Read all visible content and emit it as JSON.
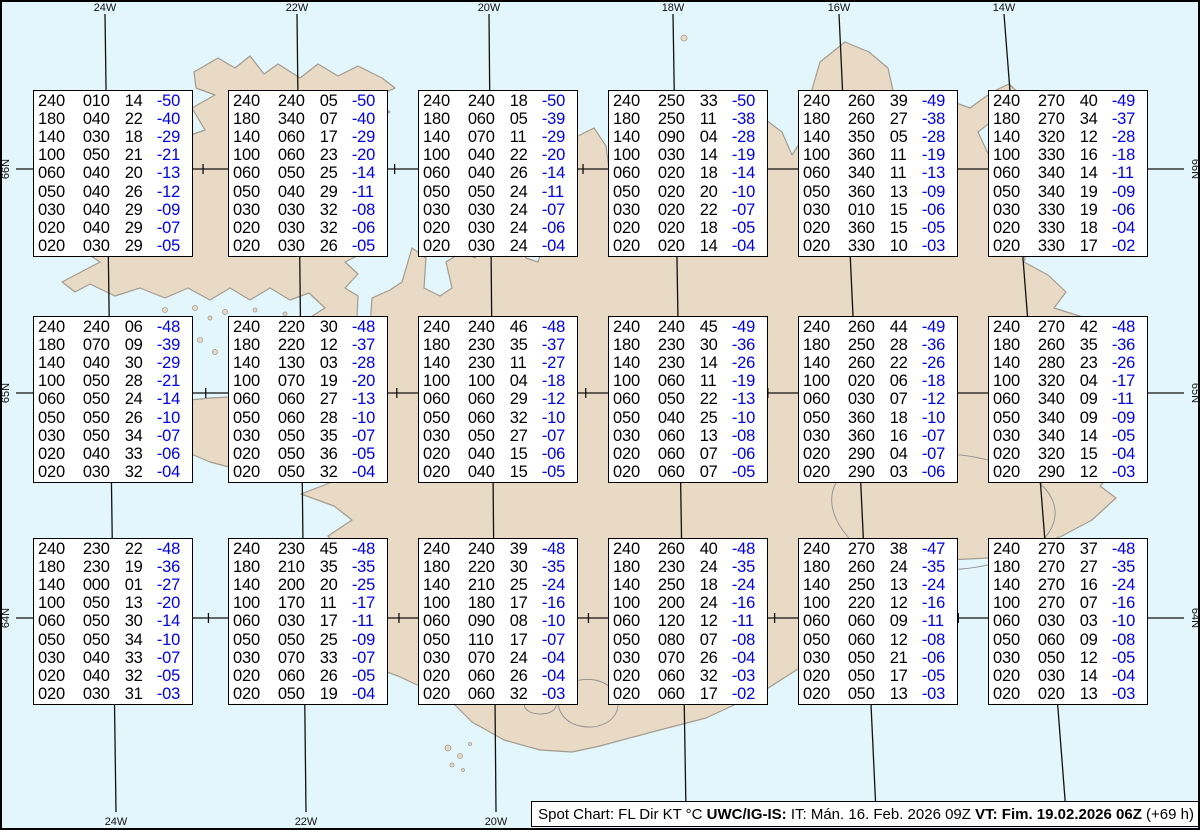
{
  "colors": {
    "ocean": "#e3f6fb",
    "land": "#e8dac5",
    "coastline": "#a39b90",
    "grid": "#111111",
    "temperature_blue": "#0000e0",
    "box_background": "#ffffff"
  },
  "graticule": {
    "meridians": [
      {
        "label": "24W",
        "x_top": 105,
        "x_bottom": 116
      },
      {
        "label": "22W",
        "x_top": 297,
        "x_bottom": 306
      },
      {
        "label": "20W",
        "x_top": 489,
        "x_bottom": 496
      },
      {
        "label": "18W",
        "x_top": 673,
        "x_bottom": 686
      },
      {
        "label": "16W",
        "x_top": 839,
        "x_bottom": 876
      },
      {
        "label": "14W",
        "x_top": 1004,
        "x_bottom": 1066
      }
    ],
    "parallels": [
      {
        "label": "66N",
        "y": 169
      },
      {
        "label": "65N",
        "y": 393
      },
      {
        "label": "64N",
        "y": 618
      }
    ]
  },
  "footer": {
    "segments": [
      {
        "text": "Spot Chart: FL Dir KT °C ",
        "bold": false
      },
      {
        "text": "UWC/IG-IS:",
        "bold": true
      },
      {
        "text": " IT: Mán. 16. Feb. 2026 09Z ",
        "bold": false
      },
      {
        "text": "VT: Fim. 19.02.2026 06Z",
        "bold": true
      },
      {
        "text": " (+69 h)",
        "bold": false
      }
    ]
  },
  "boxes": [
    {
      "x": 33,
      "y": 90,
      "rows": [
        [
          "240",
          "010",
          "14",
          "-50"
        ],
        [
          "180",
          "040",
          "22",
          "-40"
        ],
        [
          "140",
          "030",
          "18",
          "-29"
        ],
        [
          "100",
          "050",
          "21",
          "-21"
        ],
        [
          "060",
          "040",
          "20",
          "-13"
        ],
        [
          "050",
          "040",
          "26",
          "-12"
        ],
        [
          "030",
          "040",
          "29",
          "-09"
        ],
        [
          "020",
          "040",
          "29",
          "-07"
        ],
        [
          "020",
          "030",
          "29",
          "-05"
        ]
      ]
    },
    {
      "x": 228,
      "y": 90,
      "rows": [
        [
          "240",
          "240",
          "05",
          "-50"
        ],
        [
          "180",
          "340",
          "07",
          "-40"
        ],
        [
          "140",
          "060",
          "17",
          "-29"
        ],
        [
          "100",
          "060",
          "23",
          "-20"
        ],
        [
          "060",
          "050",
          "25",
          "-14"
        ],
        [
          "050",
          "040",
          "29",
          "-11"
        ],
        [
          "030",
          "030",
          "32",
          "-08"
        ],
        [
          "020",
          "030",
          "32",
          "-06"
        ],
        [
          "020",
          "030",
          "26",
          "-05"
        ]
      ]
    },
    {
      "x": 418,
      "y": 90,
      "rows": [
        [
          "240",
          "240",
          "18",
          "-50"
        ],
        [
          "180",
          "060",
          "05",
          "-39"
        ],
        [
          "140",
          "070",
          "11",
          "-29"
        ],
        [
          "100",
          "040",
          "22",
          "-20"
        ],
        [
          "060",
          "040",
          "26",
          "-14"
        ],
        [
          "050",
          "050",
          "24",
          "-11"
        ],
        [
          "030",
          "030",
          "24",
          "-07"
        ],
        [
          "020",
          "030",
          "24",
          "-06"
        ],
        [
          "020",
          "030",
          "24",
          "-04"
        ]
      ]
    },
    {
      "x": 608,
      "y": 90,
      "rows": [
        [
          "240",
          "250",
          "33",
          "-50"
        ],
        [
          "180",
          "250",
          "11",
          "-38"
        ],
        [
          "140",
          "090",
          "04",
          "-28"
        ],
        [
          "100",
          "030",
          "14",
          "-19"
        ],
        [
          "060",
          "020",
          "18",
          "-14"
        ],
        [
          "050",
          "020",
          "20",
          "-10"
        ],
        [
          "030",
          "020",
          "22",
          "-07"
        ],
        [
          "020",
          "020",
          "18",
          "-05"
        ],
        [
          "020",
          "020",
          "14",
          "-04"
        ]
      ]
    },
    {
      "x": 798,
      "y": 90,
      "rows": [
        [
          "240",
          "260",
          "39",
          "-49"
        ],
        [
          "180",
          "260",
          "27",
          "-38"
        ],
        [
          "140",
          "350",
          "05",
          "-28"
        ],
        [
          "100",
          "360",
          "11",
          "-19"
        ],
        [
          "060",
          "340",
          "11",
          "-13"
        ],
        [
          "050",
          "360",
          "13",
          "-09"
        ],
        [
          "030",
          "010",
          "15",
          "-06"
        ],
        [
          "020",
          "360",
          "15",
          "-05"
        ],
        [
          "020",
          "330",
          "10",
          "-03"
        ]
      ]
    },
    {
      "x": 988,
      "y": 90,
      "rows": [
        [
          "240",
          "270",
          "40",
          "-49"
        ],
        [
          "180",
          "270",
          "34",
          "-37"
        ],
        [
          "140",
          "320",
          "12",
          "-28"
        ],
        [
          "100",
          "330",
          "16",
          "-18"
        ],
        [
          "060",
          "340",
          "14",
          "-11"
        ],
        [
          "050",
          "340",
          "19",
          "-09"
        ],
        [
          "030",
          "330",
          "19",
          "-06"
        ],
        [
          "020",
          "330",
          "18",
          "-04"
        ],
        [
          "020",
          "330",
          "17",
          "-02"
        ]
      ]
    },
    {
      "x": 33,
      "y": 316,
      "rows": [
        [
          "240",
          "240",
          "06",
          "-48"
        ],
        [
          "180",
          "070",
          "09",
          "-39"
        ],
        [
          "140",
          "040",
          "30",
          "-29"
        ],
        [
          "100",
          "050",
          "28",
          "-21"
        ],
        [
          "060",
          "050",
          "24",
          "-14"
        ],
        [
          "050",
          "050",
          "26",
          "-10"
        ],
        [
          "030",
          "050",
          "34",
          "-07"
        ],
        [
          "020",
          "040",
          "33",
          "-06"
        ],
        [
          "020",
          "030",
          "32",
          "-04"
        ]
      ]
    },
    {
      "x": 228,
      "y": 316,
      "rows": [
        [
          "240",
          "220",
          "30",
          "-48"
        ],
        [
          "180",
          "220",
          "12",
          "-37"
        ],
        [
          "140",
          "130",
          "03",
          "-28"
        ],
        [
          "100",
          "070",
          "19",
          "-20"
        ],
        [
          "060",
          "060",
          "27",
          "-13"
        ],
        [
          "050",
          "060",
          "28",
          "-10"
        ],
        [
          "030",
          "050",
          "35",
          "-07"
        ],
        [
          "020",
          "050",
          "36",
          "-05"
        ],
        [
          "020",
          "050",
          "32",
          "-04"
        ]
      ]
    },
    {
      "x": 418,
      "y": 316,
      "rows": [
        [
          "240",
          "240",
          "46",
          "-48"
        ],
        [
          "180",
          "230",
          "35",
          "-37"
        ],
        [
          "140",
          "230",
          "11",
          "-27"
        ],
        [
          "100",
          "100",
          "04",
          "-18"
        ],
        [
          "060",
          "060",
          "29",
          "-12"
        ],
        [
          "050",
          "060",
          "32",
          "-10"
        ],
        [
          "030",
          "050",
          "27",
          "-07"
        ],
        [
          "020",
          "040",
          "15",
          "-06"
        ],
        [
          "020",
          "040",
          "15",
          "-05"
        ]
      ]
    },
    {
      "x": 608,
      "y": 316,
      "rows": [
        [
          "240",
          "240",
          "45",
          "-49"
        ],
        [
          "180",
          "230",
          "30",
          "-36"
        ],
        [
          "140",
          "230",
          "14",
          "-26"
        ],
        [
          "100",
          "060",
          "11",
          "-19"
        ],
        [
          "060",
          "050",
          "22",
          "-13"
        ],
        [
          "050",
          "040",
          "25",
          "-10"
        ],
        [
          "030",
          "060",
          "13",
          "-08"
        ],
        [
          "020",
          "060",
          "07",
          "-06"
        ],
        [
          "020",
          "060",
          "07",
          "-05"
        ]
      ]
    },
    {
      "x": 798,
      "y": 316,
      "rows": [
        [
          "240",
          "260",
          "44",
          "-49"
        ],
        [
          "180",
          "250",
          "28",
          "-36"
        ],
        [
          "140",
          "260",
          "22",
          "-26"
        ],
        [
          "100",
          "020",
          "06",
          "-18"
        ],
        [
          "060",
          "030",
          "07",
          "-12"
        ],
        [
          "050",
          "360",
          "18",
          "-10"
        ],
        [
          "030",
          "360",
          "16",
          "-07"
        ],
        [
          "020",
          "290",
          "04",
          "-07"
        ],
        [
          "020",
          "290",
          "03",
          "-06"
        ]
      ]
    },
    {
      "x": 988,
      "y": 316,
      "rows": [
        [
          "240",
          "270",
          "42",
          "-48"
        ],
        [
          "180",
          "260",
          "35",
          "-36"
        ],
        [
          "140",
          "280",
          "23",
          "-26"
        ],
        [
          "100",
          "320",
          "04",
          "-17"
        ],
        [
          "060",
          "340",
          "09",
          "-11"
        ],
        [
          "050",
          "340",
          "09",
          "-09"
        ],
        [
          "030",
          "340",
          "14",
          "-05"
        ],
        [
          "020",
          "320",
          "15",
          "-04"
        ],
        [
          "020",
          "290",
          "12",
          "-03"
        ]
      ]
    },
    {
      "x": 33,
      "y": 538,
      "rows": [
        [
          "240",
          "230",
          "22",
          "-48"
        ],
        [
          "180",
          "230",
          "19",
          "-36"
        ],
        [
          "140",
          "000",
          "01",
          "-27"
        ],
        [
          "100",
          "050",
          "13",
          "-20"
        ],
        [
          "060",
          "050",
          "30",
          "-14"
        ],
        [
          "050",
          "050",
          "34",
          "-10"
        ],
        [
          "030",
          "040",
          "33",
          "-07"
        ],
        [
          "020",
          "040",
          "32",
          "-05"
        ],
        [
          "020",
          "030",
          "31",
          "-03"
        ]
      ]
    },
    {
      "x": 228,
      "y": 538,
      "rows": [
        [
          "240",
          "230",
          "45",
          "-48"
        ],
        [
          "180",
          "210",
          "35",
          "-35"
        ],
        [
          "140",
          "200",
          "20",
          "-25"
        ],
        [
          "100",
          "170",
          "11",
          "-17"
        ],
        [
          "060",
          "030",
          "17",
          "-11"
        ],
        [
          "050",
          "050",
          "25",
          "-09"
        ],
        [
          "030",
          "070",
          "33",
          "-07"
        ],
        [
          "020",
          "060",
          "26",
          "-05"
        ],
        [
          "020",
          "050",
          "19",
          "-04"
        ]
      ]
    },
    {
      "x": 418,
      "y": 538,
      "rows": [
        [
          "240",
          "240",
          "39",
          "-48"
        ],
        [
          "180",
          "220",
          "30",
          "-35"
        ],
        [
          "140",
          "210",
          "25",
          "-24"
        ],
        [
          "100",
          "180",
          "17",
          "-16"
        ],
        [
          "060",
          "090",
          "08",
          "-10"
        ],
        [
          "050",
          "110",
          "17",
          "-07"
        ],
        [
          "030",
          "070",
          "24",
          "-04"
        ],
        [
          "020",
          "060",
          "26",
          "-04"
        ],
        [
          "020",
          "060",
          "32",
          "-03"
        ]
      ]
    },
    {
      "x": 608,
      "y": 538,
      "rows": [
        [
          "240",
          "260",
          "40",
          "-48"
        ],
        [
          "180",
          "230",
          "24",
          "-35"
        ],
        [
          "140",
          "250",
          "18",
          "-24"
        ],
        [
          "100",
          "200",
          "24",
          "-16"
        ],
        [
          "060",
          "120",
          "12",
          "-11"
        ],
        [
          "050",
          "080",
          "07",
          "-08"
        ],
        [
          "030",
          "070",
          "26",
          "-04"
        ],
        [
          "020",
          "060",
          "32",
          "-03"
        ],
        [
          "020",
          "060",
          "17",
          "-02"
        ]
      ]
    },
    {
      "x": 798,
      "y": 538,
      "rows": [
        [
          "240",
          "270",
          "38",
          "-47"
        ],
        [
          "180",
          "260",
          "24",
          "-35"
        ],
        [
          "140",
          "250",
          "13",
          "-24"
        ],
        [
          "100",
          "220",
          "12",
          "-16"
        ],
        [
          "060",
          "060",
          "09",
          "-11"
        ],
        [
          "050",
          "060",
          "12",
          "-08"
        ],
        [
          "030",
          "050",
          "21",
          "-06"
        ],
        [
          "020",
          "050",
          "17",
          "-05"
        ],
        [
          "020",
          "050",
          "13",
          "-03"
        ]
      ]
    },
    {
      "x": 988,
      "y": 538,
      "rows": [
        [
          "240",
          "270",
          "37",
          "-48"
        ],
        [
          "180",
          "270",
          "27",
          "-35"
        ],
        [
          "140",
          "270",
          "16",
          "-24"
        ],
        [
          "100",
          "270",
          "07",
          "-16"
        ],
        [
          "060",
          "030",
          "03",
          "-10"
        ],
        [
          "050",
          "060",
          "09",
          "-08"
        ],
        [
          "030",
          "050",
          "12",
          "-05"
        ],
        [
          "020",
          "030",
          "14",
          "-04"
        ],
        [
          "020",
          "020",
          "13",
          "-03"
        ]
      ]
    }
  ]
}
